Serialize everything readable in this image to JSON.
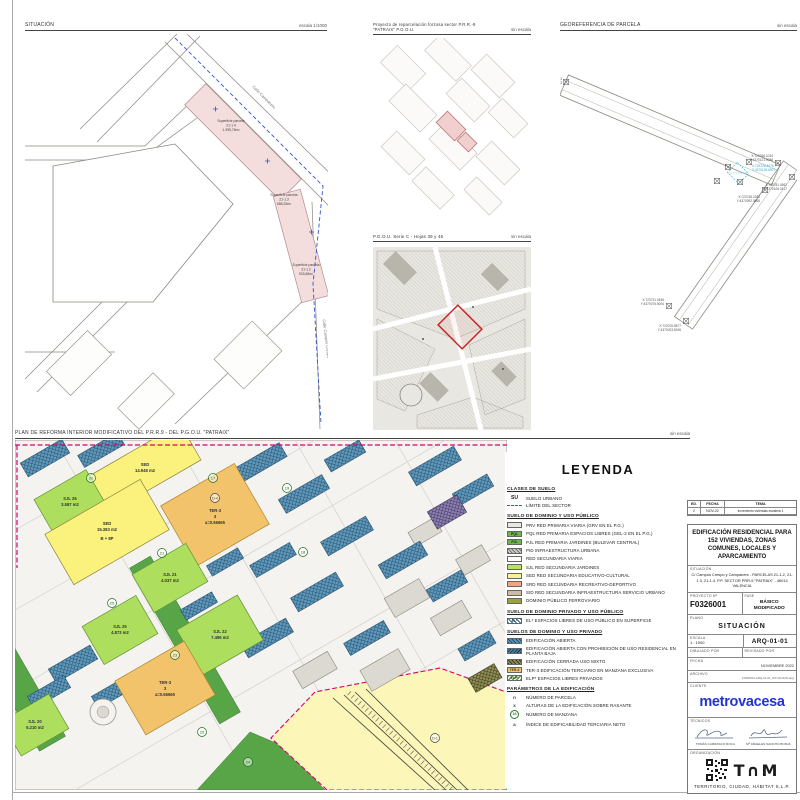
{
  "sheet": {
    "plot_stamp": "F0326001 · ARQ-01-01 · SITUACIÓN"
  },
  "situacion": {
    "title": "SITUACIÓN",
    "scale": "escala 1/1000",
    "streets": {
      "campaners": "Calle Campaners",
      "campos_crespo": "Calle Campos Crespo"
    },
    "parcels": [
      {
        "l1": "Superficie parcela",
        "l2": "21-1.4",
        "l3": "1.395,76m²"
      },
      {
        "l1": "Superficie parcela",
        "l2": "21-1.3",
        "l3": "658,26m²"
      },
      {
        "l1": "Superficie parcela",
        "l2": "21-1.2",
        "l3": "933,68m²"
      }
    ]
  },
  "reparcelacion": {
    "title": "Proyecto de reparcelación forzosa sector P.R.R.-9 \"PATRAIX\" P.G.O.U.",
    "scale": "sin escala"
  },
  "pgou": {
    "title": "P.G.O.U. Serie C - Hojas 39 y 46",
    "scale": "sin escala"
  },
  "georef": {
    "title": "GEOREFERENCIA DE PARCELA",
    "scale": "sin escala",
    "points": [
      {
        "l1": "X:723689.6891",
        "l2": "Y:4370147.4623"
      },
      {
        "l1": "X:723766.1034",
        "l2": "Y:4370121.9088"
      },
      {
        "l1": "X:723781.4562",
        "l2": "Y:4370106.2417"
      },
      {
        "l1": "X:723705.5877",
        "l2": "Y:4370023.8156"
      },
      {
        "l1": "X:723731.0456",
        "l2": "Y:4370075.5004"
      },
      {
        "l1": "X:723748.2280",
        "l2": "Y:4370092.3665"
      }
    ],
    "parcel_point": {
      "l1": "X:723726.4476",
      "l2": "Y:4370100.6507"
    }
  },
  "plan": {
    "title": "PLAN DE REFORMA INTERIOR MODIFICATIVO DEL P.R.R.9 - DEL P.G.O.U. \"PATRAIX\"",
    "scale": "sin escala",
    "blocks": [
      {
        "l1": "SED",
        "l2": "14.948 m2"
      },
      {
        "l1": "SJL 26",
        "l2": "3.587 m2"
      },
      {
        "l1": "SED",
        "l2": "15.383 m2",
        "l3": "B + 8P"
      },
      {
        "l1": "TER-3",
        "l2": "3",
        "l3": "a=0.66665"
      },
      {
        "l1": "SJL 21",
        "l2": "4.037 m2"
      },
      {
        "l1": "SJL 25",
        "l2": "4.873 m2"
      },
      {
        "l1": "SJL 22",
        "l2": "7.496 m2"
      },
      {
        "l1": "SJL 20",
        "l2": "5.210 m2"
      },
      {
        "l1": "TER-3",
        "l2": "3",
        "l3": "a=0.66665"
      }
    ],
    "manzanas": [
      "17",
      "19",
      "20",
      "18",
      "21",
      "25",
      "23",
      "22",
      "24",
      "D-1",
      "D-4"
    ]
  },
  "legend": {
    "title": "LEYENDA",
    "sections": [
      "CLASES DE SUELO",
      "SUELO DE DOMINIO Y USO PÚBLICO",
      "SUELO DE DOMINIO PRIVADO Y USO PÚBLICO",
      "SUELOS DE DOMINIO Y USO PRIVADO",
      "PARÁMETROS DE LA EDIFICACIÓN"
    ],
    "items": [
      {
        "code": "SU",
        "label": "SUELO URBANO"
      },
      {
        "code": "",
        "label": "LÍMITE DEL SECTOR"
      },
      {
        "code": "",
        "label": "PRV RED PRIMARIA VIARIA (GRV EN EL P.G.)"
      },
      {
        "code": "PQL",
        "label": "PQL RED PRIMARIA ESPACIOS LIBRES (GEL-2 EN EL P.G.)"
      },
      {
        "code": "PJL",
        "label": "PJL RED PRIMARIA JARDINES (BULEVAR CENTRAL)"
      },
      {
        "code": "",
        "label": "PID INFRAESTRUCTURA URBANA"
      },
      {
        "code": "",
        "label": "RED SECUNDARIA VIARIA"
      },
      {
        "code": "",
        "label": "SJL RED SECUNDARIA JARDINES"
      },
      {
        "code": "",
        "label": "SED RED SECUNDARIA EDUCATIVO-CULTURAL"
      },
      {
        "code": "",
        "label": "SRD RED SECUNDARIA RECREATIVO-DEPORTIVO"
      },
      {
        "code": "",
        "label": "SID RED SECUNDARIA INFRAESTRUCTURA SERVICIO URBANO"
      },
      {
        "code": "",
        "label": "DOMINIO PÚBLICO FERROVIARIO"
      },
      {
        "code": "EL*",
        "label": "EL* ESPACIOS LIBRES DE USO PÚBLICO EN SUPERFICIE"
      },
      {
        "code": "",
        "label": "EDIFICACIÓN ABIERTA"
      },
      {
        "code": "",
        "label": "EDIFICACIÓN ABIERTA CON PROHIBICIÓN DE USO RESIDENCIAL EN PLANTA BAJA"
      },
      {
        "code": "",
        "label": "EDIFICACIÓN CERRADA USO MIXTO"
      },
      {
        "code": "TER-3",
        "label": "TER-3 EDIFICACIÓN TERCIARIO EN MANZANA EXCLUSIVA"
      },
      {
        "code": "ELP*",
        "label": "ELP* ESPACIOS LIBRES PRIVADOS"
      },
      {
        "sym": "n",
        "label": "NÚMERO DE PARCELA"
      },
      {
        "sym": "x",
        "label": "ALTURAS DE LA EDIFICACIÓN SOBRE RASANTE"
      },
      {
        "sym": "24",
        "label": "NÚMERO DE MANZANA"
      },
      {
        "sym": "a",
        "label": "ÍNDICE DE EDIFICABILIDAD TERCIARIA NETO"
      }
    ]
  },
  "titleblock": {
    "rev": {
      "col_ed": "ED.",
      "col_fecha": "FECHA",
      "col_tema": "TEMA",
      "row_ed": "2",
      "row_fecha": "NOV-22",
      "row_tema": "Incremento viviendas escalera 1"
    },
    "project_title": "EDIFICACIÓN RESIDENCIAL PARA 152 VIVIENDAS, ZONAS COMUNES, LOCALES Y APARCAMIENTO",
    "situacion_label": "SITUACIÓN",
    "situacion_value": "C/ Campos Crespo y Campaners - PARCELAS 21-1.2, 21-1.3, 21-1.4. P.P. SECTOR PRR-9 \"PATRAIX\" - 46014 VALENCIA",
    "proyecto_label": "PROYECTO Nº",
    "proyecto_value": "F0326001",
    "fase_label": "FASE",
    "fase_value": "BÁSICO MODIFICADO",
    "plano_label": "PLANO",
    "plano_value": "SITUACIÓN",
    "escala_label": "ESCALA",
    "escala_value": "1 : 1000",
    "drawing_number": "ARQ-01-01",
    "dibujado_label": "DIBUJADO POR",
    "revisado_label": "REVISADO POR",
    "fecha_label": "FECHA",
    "fecha_value": "NOVIEMBRE 2022",
    "archivo_label": "ARCHIVO",
    "archivo_value": "F0326001-ARQ-01-01_SITUACION.dwg",
    "cliente_label": "CLIENTE",
    "cliente_logo": "metrovacesa",
    "tecnicos_label": "TÉCNICOS",
    "tecnico1": "TOMÁS CARRASCO ROCA",
    "tecnico2": "Mª ÁNGELES SANCHO BORJA",
    "organizacion_label": "ORGANIZACIÓN",
    "org_logo": "T∩M",
    "org_name": "TERRITORIO, CIUDAD, HÁBITAT  S.L.P."
  }
}
